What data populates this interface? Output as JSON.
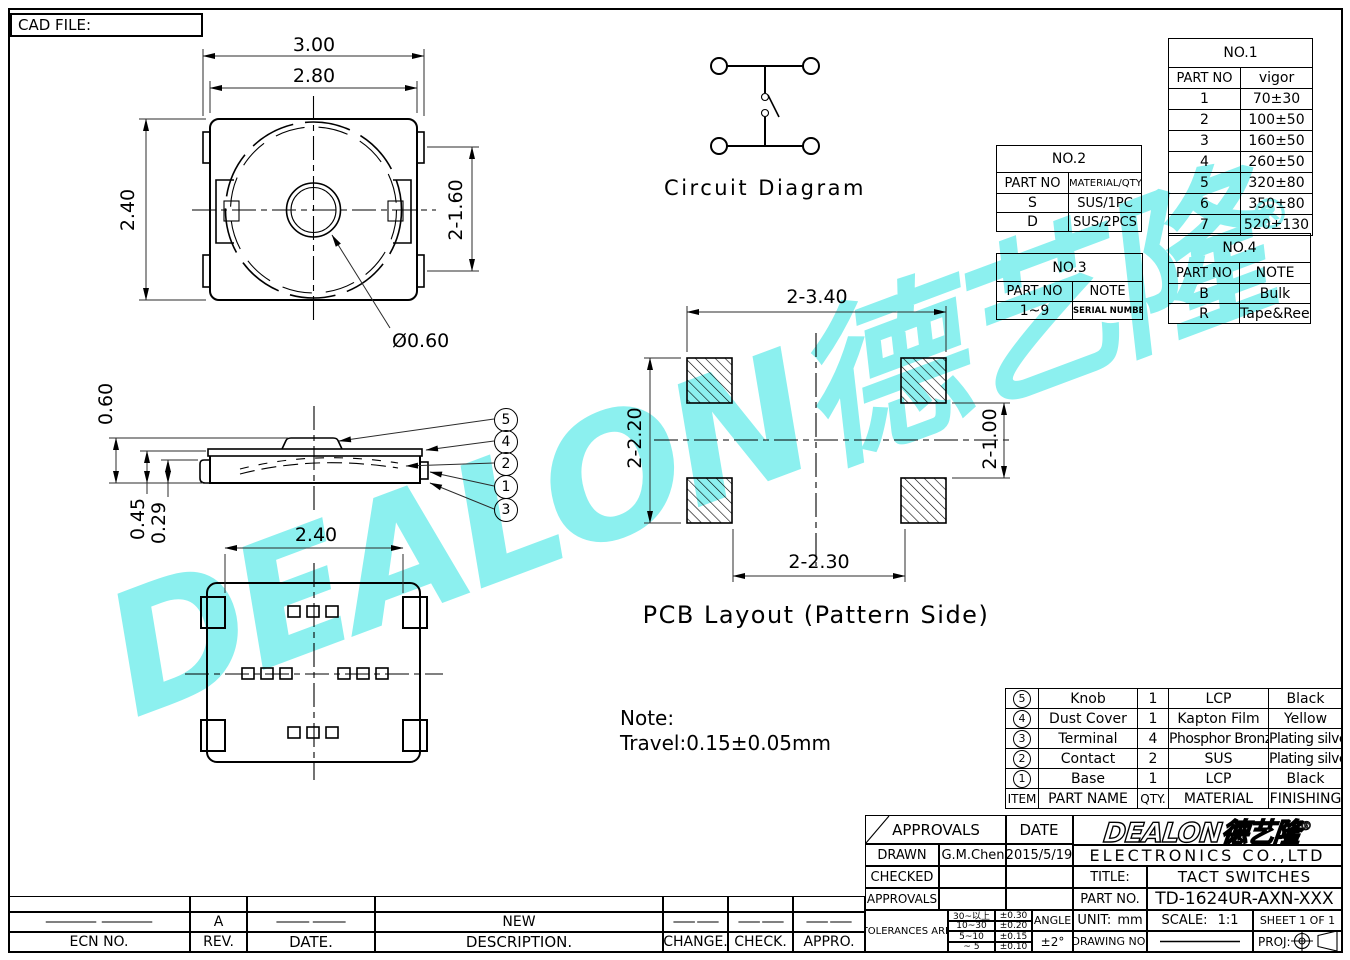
{
  "meta": {
    "cad_file_label": "CAD FILE:"
  },
  "watermark": {
    "text": "DEALON德艺隆",
    "reg": "®",
    "color": "#8CF0EF"
  },
  "views": {
    "top": {
      "dim_width_outer": "3.00",
      "dim_width_body": "2.80",
      "dim_height": "2.40",
      "dim_terminal_pitch": "2-1.60",
      "dim_hole": "Ø0.60"
    },
    "circuit": {
      "label": "Circuit Diagram"
    },
    "side": {
      "dim_total_height": "0.60",
      "dim_body_height": "0.45",
      "dim_base_height": "0.29",
      "callouts": [
        "5",
        "4",
        "2",
        "1",
        "3"
      ]
    },
    "bottom": {
      "dim_width": "2.40"
    },
    "pcb": {
      "label": "PCB Layout (Pattern Side)",
      "dim_outer_width": "2-3.40",
      "dim_outer_height": "2-2.20",
      "dim_inner_height": "2-1.00",
      "dim_inner_width": "2-2.30"
    },
    "note": {
      "title": "Note:",
      "body": "Travel:0.15±0.05mm"
    }
  },
  "tables": {
    "no1": {
      "title": "NO.1",
      "headers": [
        "PART NO",
        "vigor"
      ],
      "rows": [
        [
          "1",
          "70±30"
        ],
        [
          "2",
          "100±50"
        ],
        [
          "3",
          "160±50"
        ],
        [
          "4",
          "260±50"
        ],
        [
          "5",
          "320±80"
        ],
        [
          "6",
          "350±80"
        ],
        [
          "7",
          "520±130"
        ]
      ]
    },
    "no2": {
      "title": "NO.2",
      "headers": [
        "PART NO",
        "MATERIAL/QTY"
      ],
      "rows": [
        [
          "S",
          "SUS/1PC"
        ],
        [
          "D",
          "SUS/2PCS"
        ]
      ]
    },
    "no3": {
      "title": "NO.3",
      "headers": [
        "PART NO",
        "NOTE"
      ],
      "rows": [
        [
          "1~9",
          "SERIAL NUMBER"
        ]
      ]
    },
    "no4": {
      "title": "NO.4",
      "headers": [
        "PART NO",
        "NOTE"
      ],
      "rows": [
        [
          "B",
          "Bulk"
        ],
        [
          "R",
          "Tape&Reel"
        ]
      ]
    },
    "parts": {
      "headers": [
        "ITEM",
        "PART NAME",
        "QTY.",
        "MATERIAL",
        "FINISHING"
      ],
      "rows": [
        [
          "5",
          "Knob",
          "1",
          "LCP",
          "Black"
        ],
        [
          "4",
          "Dust Cover",
          "1",
          "Kapton Film",
          "Yellow"
        ],
        [
          "3",
          "Terminal",
          "4",
          "Phosphor Bronze",
          "Plating silver"
        ],
        [
          "2",
          "Contact",
          "2",
          "SUS",
          "Plating silver"
        ],
        [
          "1",
          "Base",
          "1",
          "LCP",
          "Black"
        ]
      ]
    }
  },
  "title_block": {
    "approvals_header": "APPROVALS",
    "date_header": "DATE",
    "rows": [
      {
        "label": "DRAWN",
        "name": "G.M.Chen",
        "date": "2015/5/19"
      },
      {
        "label": "CHECKED",
        "name": "",
        "date": ""
      },
      {
        "label": "APPROVALS",
        "name": "",
        "date": ""
      }
    ],
    "tolerances_label": "TOLERANCES ARE",
    "tolerances": [
      [
        "30~以上",
        "±0.30"
      ],
      [
        "10~30",
        "±0.20"
      ],
      [
        "5~10",
        "±0.15"
      ],
      [
        "~ 5",
        "±0.10"
      ]
    ],
    "angle_label": "ANGLE",
    "angle_value": "±2°",
    "logo_text": "DEALON德艺隆",
    "logo_reg": "®",
    "company": "ELECTRONICS CO.,LTD",
    "title_label": "TITLE:",
    "title_value": "TACT SWITCHES",
    "part_no_label": "PART NO.",
    "part_no_value": "TD-1624UR-AXN-XXX",
    "unit_label": "UNIT:",
    "unit_value": "mm",
    "scale_label": "SCALE:",
    "scale_value": "1:1",
    "sheet_label": "SHEET 1 OF 1",
    "drawing_no_label": "DRAWING NO.",
    "proj_label": "PROJ:"
  },
  "revision": {
    "headers": [
      "ECN NO.",
      "REV.",
      "DATE.",
      "DESCRIPTION.",
      "CHANGE.",
      "CHECK.",
      "APPRO."
    ],
    "entry": {
      "ecn": "——",
      "rev": "A",
      "date": "——",
      "description": "NEW",
      "change": "——",
      "check": "——",
      "appro": "——"
    }
  }
}
